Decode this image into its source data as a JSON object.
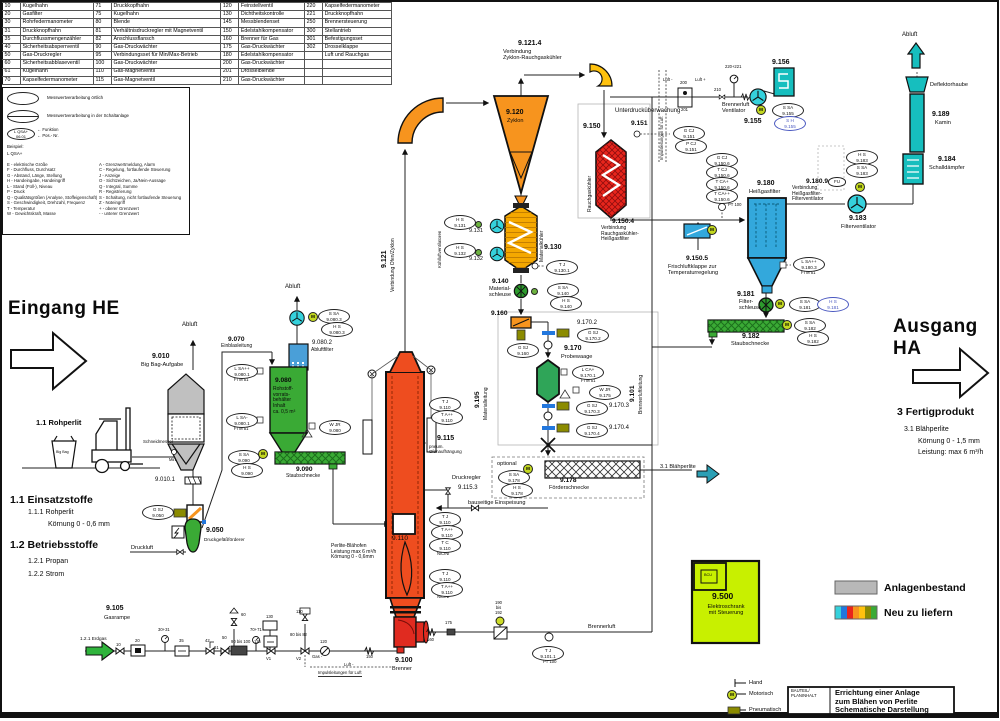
{
  "parts_table": {
    "rows": [
      [
        "10",
        "Kugelhahn",
        "71",
        "Druckkopfhahn",
        "120",
        "Feinstellventil",
        "220",
        "Kapselfedermanometer"
      ],
      [
        "20",
        "Gasfilter",
        "75",
        "Kugelhahn",
        "130",
        "Dichtheitskontrolle",
        "221",
        "Druckknopfhahn"
      ],
      [
        "30",
        "Rohrfedermanometer",
        "80",
        "Blende",
        "145",
        "Messblendenset",
        "250",
        "Brennersteuerung"
      ],
      [
        "31",
        "Druckknopfhahn",
        "81",
        "Verhältnisdruckregler mit Magnetventil",
        "150",
        "Edelstahlkompensator",
        "300",
        "Stellantrieb"
      ],
      [
        "35",
        "Durchflussmengenzähler",
        "82",
        "Anschlussflansch",
        "160",
        "Brenner für Gas",
        "301",
        "Befestigungsset"
      ],
      [
        "40",
        "Sicherheitsabsperrventil",
        "90",
        "Gas-Druckwächter",
        "175",
        "Gas-Druckwächter",
        "302",
        "Drosselklappe"
      ],
      [
        "50",
        "Gas-Druckregler",
        "95",
        "Verbindungsset für Min/Max-Betrieb",
        "180",
        "Edelstahlkompensator",
        "",
        "Luft und Rauchgas"
      ],
      [
        "60",
        "Sicherheitsabblaseventil",
        "100",
        "Gas-Druckwächter",
        "200",
        "Gas-Druckwächter",
        "",
        ""
      ],
      [
        "61",
        "Kugelhahn",
        "110",
        "Gas-Magnetventil",
        "201",
        "Drosselblende",
        "",
        ""
      ],
      [
        "70",
        "Kapselfedermanometer",
        "115",
        "Gas-Magnetventil",
        "210",
        "Gas-Druckwächter",
        "",
        ""
      ]
    ]
  },
  "legend_box": {
    "l1": "Messwertverarbeitung örtlich",
    "l2": "Messwertverarbeitung in der Schaltanlage",
    "code": "L QSA+",
    "num": "06.01",
    "funktion": "← Funktion",
    "posnr": "← Pos.- Nr.",
    "beispiel": "Beispiel:",
    "example2": "L QSA+",
    "left": [
      "E - elektrische Größe",
      "F - Durchfluss, Durchsatz",
      "G - Abstand, Länge, Stellung",
      "H - Handeingabe, Handeingriff",
      "L - Stand (Füll-), Niveau",
      "P - Druck",
      "Q - Qualitätsgrößen (Analyse, Stoffeigenschaft)",
      "S - Geschwindigkeit, Drehzahl, Frequenz",
      "T - Temperatur",
      "W - Gewichtskraft, Masse"
    ],
    "right": [
      "A - Grenzwertmeldung, Alarm",
      "C - Regelung, fortlaufende Steuerung",
      "J - Anzeige",
      "O - Sichtzeichen, Ja/Nein-Aussage",
      "Q - Integral, Summe",
      "R - Registrierung",
      "S - Schaltung, nicht fortlaufende Steuerung",
      "Z - Noteingriff",
      "+ - oberer Grenzwert",
      "-  - unterer Grenzwert"
    ]
  },
  "labels": {
    "eingang": "Eingang HE",
    "ausgang": "Ausgang HA",
    "rohperlit": "1.1  Rohperlit",
    "bigbag": "Big Bag",
    "n9010": "9.010",
    "n9010sub": "Big Bag-Aufgabe",
    "n9010_1": "9.010.1",
    "abluft1": "Abluft",
    "abluft2": "Abluft",
    "abluft3": "Abluft",
    "schneidmesser": "Schneidmesser",
    "min": "Min",
    "n9070": "9.070",
    "einblas": "Einblasleitung",
    "n9080_2": "9.080.2",
    "abluftfilter": "Abluftfilter",
    "n9080": "9.080",
    "v9080": "Rohstoff-\nvorrats-\nbehälter\nInhalt\nca. 0,5 m³",
    "n9090": "9.090",
    "staubschnecke1": "Staubschnecke",
    "n9050": "9.050",
    "druckgef": "Druckgefäßförderer",
    "druckluft": "Druckluft",
    "einsatz": "1.1 Einsatzstoffe",
    "e111": "1.1.1  Rohperlit",
    "koern06": "Körnung 0 - 0,6 mm",
    "betrieb": "1.2 Betriebsstoffe",
    "b121": "1.2.1  Propan",
    "b122": "1.2.2  Strom",
    "n9105": "9.105",
    "gasrampe": "Gasrampe",
    "erdgas": "1.2.1  Erdgas",
    "g10": "10",
    "g20": "20",
    "g3031": "30+31",
    "g35": "35",
    "g42": "42",
    "g50": "50",
    "g60": "60",
    "g61": "61",
    "g90": "90 bis 100",
    "g7071": "70+71",
    "g130": "130",
    "g115": "115",
    "gV1": "V1",
    "g110": "110",
    "gV2": "V2",
    "g8082": "80 bis 82",
    "g120": "120",
    "gasminus": "Gas -",
    "g150": "150",
    "g160": "160",
    "g175": "175",
    "g190": "190\nbis\n192",
    "luftminus": "Luft -",
    "imp": "Impulsleitungen für Luft",
    "n9110": "9.110",
    "ofenspecs": "Perlite-Blähofen\nLeistung max 6 m³/h\nKörnung 0 - 0,6mm",
    "n9100": "9.100",
    "brenner": "Brenner",
    "n9115": "9.115",
    "pneum": "pneum.\nOfenaufhängung",
    "druckregler": "Druckregler",
    "n9115_3": "9.115.3",
    "bauseitig": "bauseitige Einspeisung",
    "n9121": "9.121",
    "verb_oz": "Verbindung Ofen/Zyklon",
    "n9120": "9.120",
    "zyklon": "Zyklon",
    "n9121_4": "9.121.4",
    "verb_zr": "Verbindung\nZyklon-Rauchgaskühler",
    "kuehlluft": "Kühlluftventilatoren",
    "n9131": "9.131",
    "n9132": "9.132",
    "n9130": "9.130",
    "matkuehler": "Materialkühler",
    "n9140": "9.140",
    "matschleuse": "Material-\nschleuse",
    "n9160": "9.160",
    "n9170": "9.170",
    "probewaage": "Probewaage",
    "n9170_2": "9.170.2",
    "n9170_3": "9.170.3",
    "n9170_4": "9.170.4",
    "n9195": "9.195",
    "matleitung": "Materialleitung",
    "n9101": "9.101",
    "brennerluftltg": "Brennerluftleitung",
    "optional": "optional",
    "n9178": "9.178",
    "foerder": "Förderschnecke",
    "blaeh_out": "3.1  Blähperlite",
    "n9150": "9.150",
    "rgk": "Rauchgaskühler",
    "unterdruck": "Unterdrucküberwachung",
    "n9151": "9.151",
    "n9150_4": "9.150.4",
    "verb_rh": "Verbindung\nRauchgaskühler-\nHeißgasfilter",
    "n9150_5": "9.150.5",
    "frischluft": "Frischluftklappe zur\nTemperaturregelung",
    "luftm": "Luft -",
    "luftp": "Luft +",
    "g200": "200",
    "g201": "201",
    "g210": "210",
    "g220": "220+221",
    "bl_vent": "Brennerluft\nVentilator",
    "n9155": "9.155",
    "n9156": "9.156",
    "impulsluft": "Impulsleitungen für Luft",
    "n9180": "9.180",
    "hgf": "Heißgasfilter",
    "n9180_9": "9.180.9",
    "verb_hf": "Verbindung\nHeißgasfilter-\nFilterventilator",
    "n9181": "9.181",
    "filterschleuse": "Filter-\nschleuse",
    "n9182": "9.182",
    "staubschnecke2": "Staubschnecke",
    "n9183": "9.183",
    "filterventilator": "Filterventilator",
    "n9184": "9.184",
    "schalld": "Schalldämpfer",
    "n9189": "9.189",
    "kamin": "Kamin",
    "deflektor": "Deflektorhaube",
    "brennerluft": "Brennerluft",
    "fertig": "3 Fertigprodukt",
    "f31": "3.1  Blähperlite",
    "koern15": "Körnung 0 - 1,5 mm",
    "leist6": "Leistung:  max 6 m³/h",
    "n9500": "9.500",
    "elektro": "Elektroschrank\nmit Steuerung",
    "bcu": "BCU",
    "anlagen": "Anlagenbestand",
    "neu": "Neu zu liefern",
    "hand": "Hand",
    "motorisch": "Motorisch",
    "pneumatisch": "Pneumatisch",
    "tb_small": "BAUTEIL/\nPLANINHALT",
    "tb_text": "Errichtung einer Anlage\nzum Blähen von Perlite\nSchematische Darstellung",
    "m": "M",
    "sub_ftm": "FTM 51",
    "sub_pt": "PT 100",
    "sub_ni": "NiCrNi"
  },
  "bubbles": {
    "b1": [
      "S SA",
      "9.080.3"
    ],
    "b2": [
      "H S",
      "9.080.3"
    ],
    "b3": [
      "L SA++",
      "9.080.1"
    ],
    "b4": [
      "L SA-",
      "9.080.1"
    ],
    "b5": [
      "W JR",
      "9.080"
    ],
    "b6": [
      "S SA",
      "9.090"
    ],
    "b7": [
      "H S",
      "9.090"
    ],
    "b8": [
      "G SJ",
      "9.050"
    ],
    "b9": [
      "T J",
      "9.110"
    ],
    "b10": [
      "T A++",
      "9.110"
    ],
    "b11": [
      "T J",
      "9.110"
    ],
    "b12": [
      "T A++",
      "9.110"
    ],
    "b13": [
      "T C",
      "9.110"
    ],
    "b14": [
      "T J",
      "9.110"
    ],
    "b15": [
      "T A++",
      "9.110"
    ],
    "b16": [
      "T J",
      "9.101.1"
    ],
    "b17": [
      "H S",
      "9.131"
    ],
    "b18": [
      "H S",
      "9.132"
    ],
    "b19": [
      "T J",
      "9.130.1"
    ],
    "b20": [
      "S SA",
      "9.140"
    ],
    "b21": [
      "H S",
      "9.140"
    ],
    "b22": [
      "G SJ",
      "9.160"
    ],
    "b23": [
      "G SJ",
      "9.170.2"
    ],
    "b24": [
      "L CA+",
      "9.170.1"
    ],
    "b25": [
      "W JR",
      "9.175"
    ],
    "b26": [
      "G SJ",
      "9.170.3"
    ],
    "b27": [
      "G SJ",
      "9.170.4"
    ],
    "b28": [
      "S SA",
      "9.178"
    ],
    "b29": [
      "H S",
      "9.178"
    ],
    "b30": [
      "G CJ",
      "9.151"
    ],
    "b31": [
      "P CJ",
      "9.151"
    ],
    "b32": [
      "S SA",
      "9.155"
    ],
    "b33": [
      "S H",
      "9.155"
    ],
    "b34": [
      "G CJ",
      "9.150.6"
    ],
    "b35": [
      "T CJ",
      "9.150.6"
    ],
    "b36": [
      "T CA+",
      "9.150.6"
    ],
    "b37": [
      "T CA++",
      "9.150.6"
    ],
    "b38": [
      "L SA++",
      "9.180.3"
    ],
    "b39": [
      "S SA",
      "9.181"
    ],
    "b40": [
      "H S",
      "9.181"
    ],
    "b41": [
      "S SA",
      "9.182"
    ],
    "b42": [
      "H S",
      "9.182"
    ],
    "b43": [
      "H S",
      "9.183"
    ],
    "b44": [
      "S SA",
      "9.183"
    ],
    "fu": [
      "FU"
    ]
  },
  "colors": {
    "new_equipment": [
      "#35d1dc",
      "#2277dd",
      "#e8251c",
      "#F7941E",
      "#FFC20E",
      "#8b8b00",
      "#3aaa35"
    ],
    "anlagenbestand": "#b8b8b8"
  }
}
